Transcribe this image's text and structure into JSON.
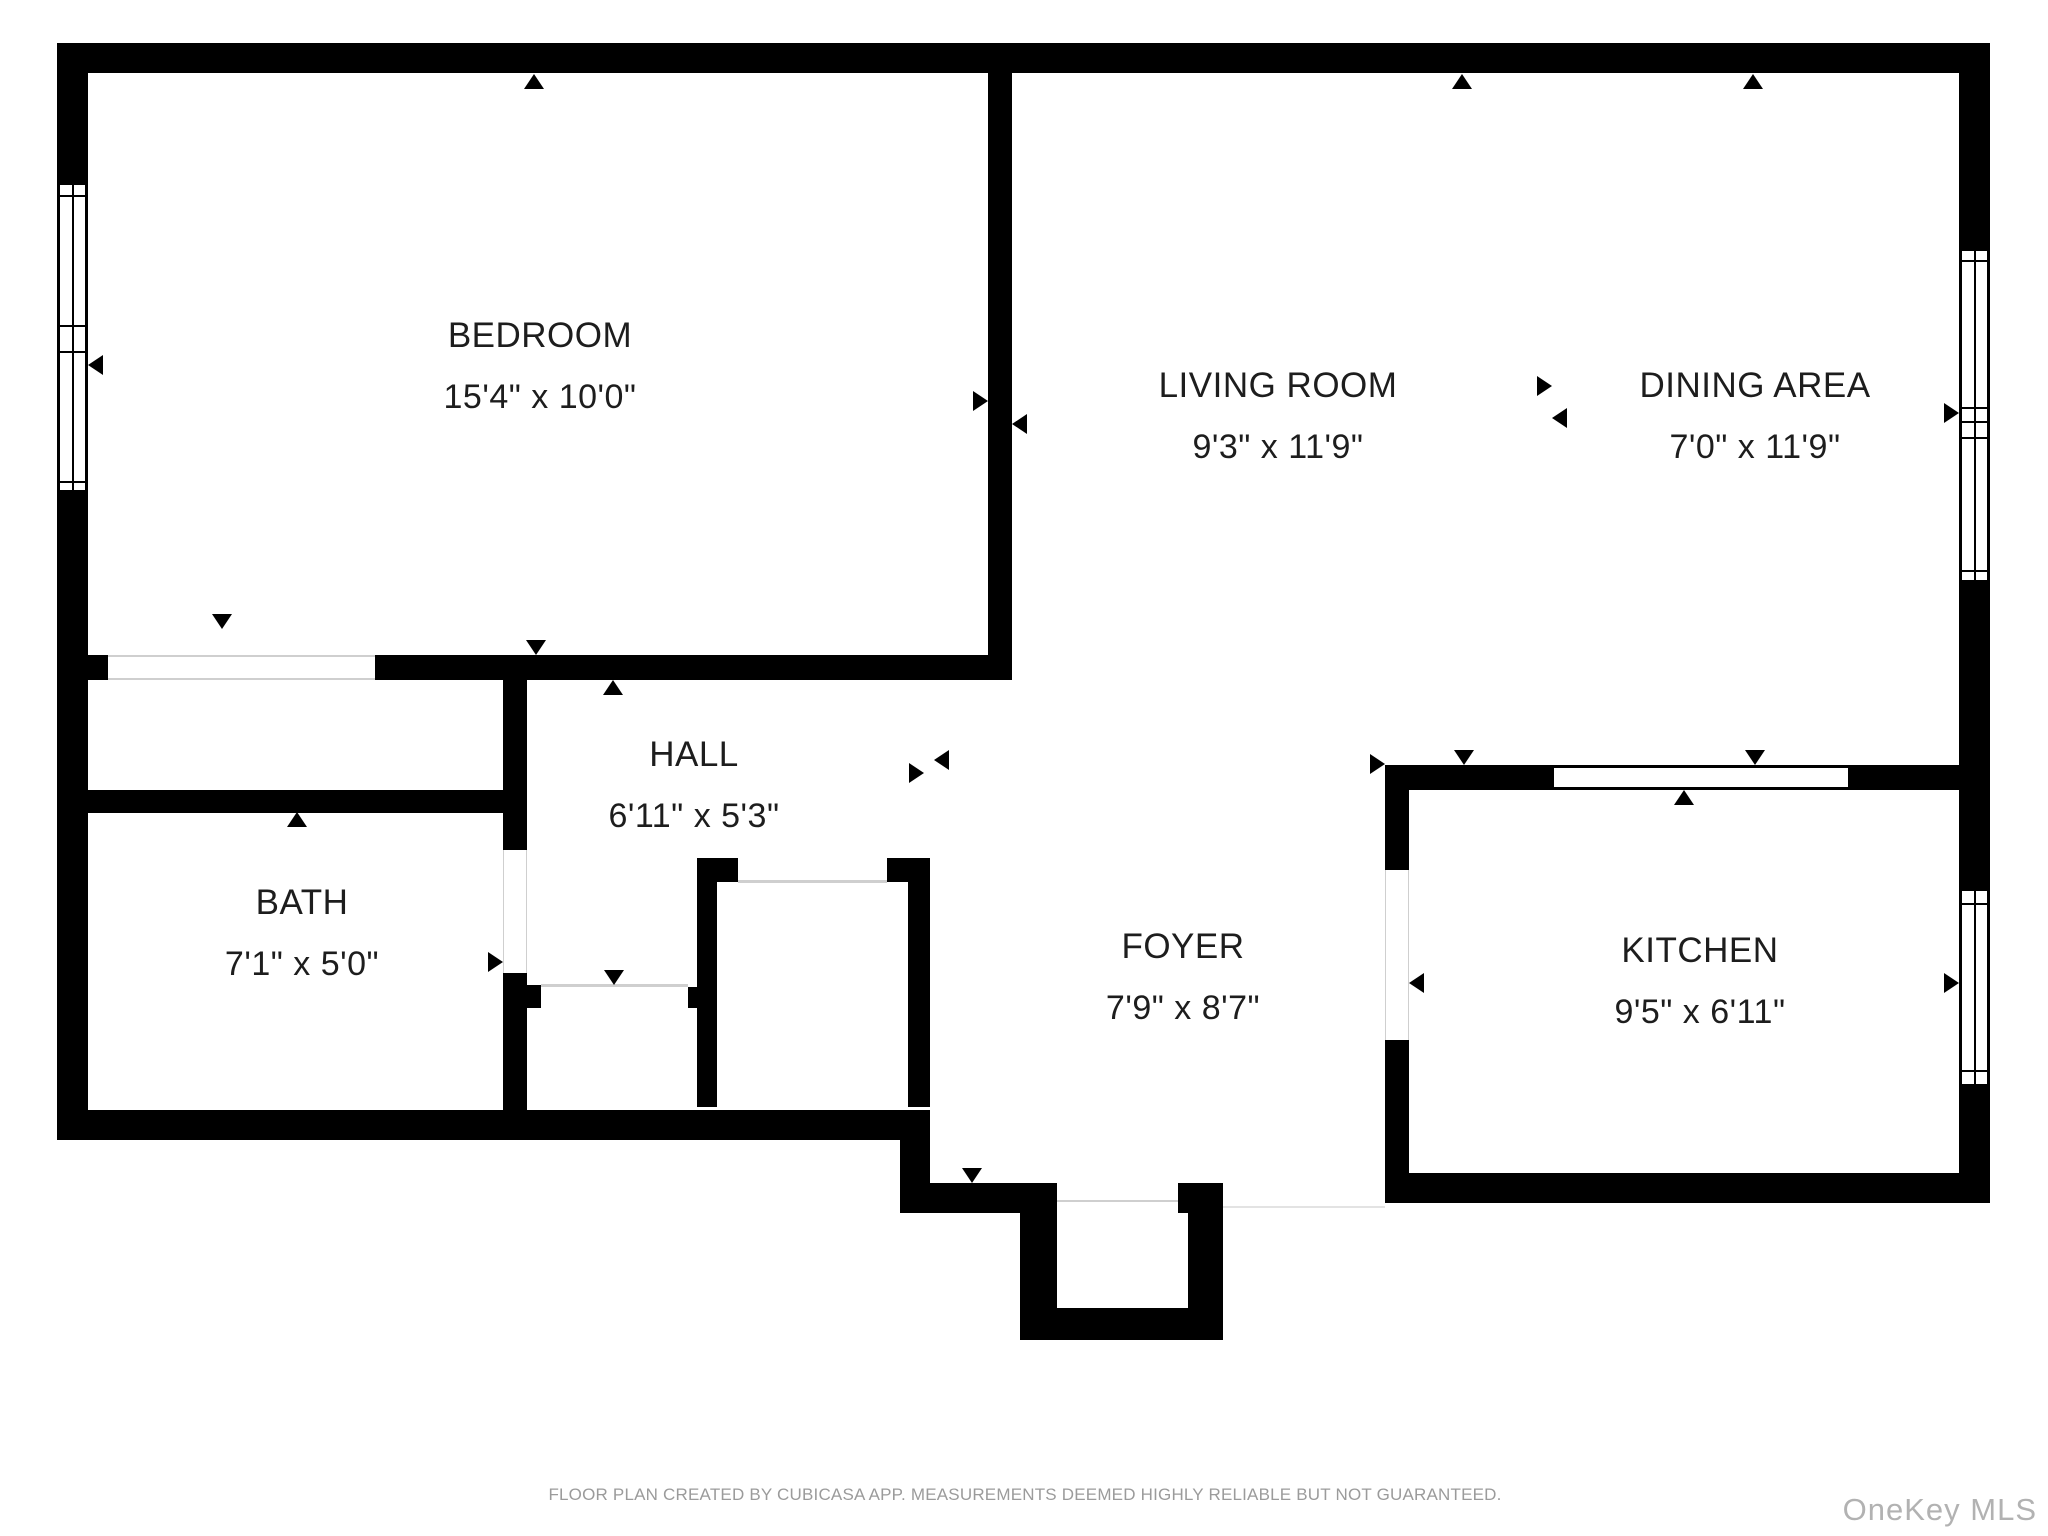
{
  "floor_plan": {
    "rooms": [
      {
        "id": "bedroom",
        "name": "BEDROOM",
        "dimensions": "15'4\" x 10'0\""
      },
      {
        "id": "living-room",
        "name": "LIVING ROOM",
        "dimensions": "9'3\" x 11'9\""
      },
      {
        "id": "dining-area",
        "name": "DINING AREA",
        "dimensions": "7'0\" x 11'9\""
      },
      {
        "id": "hall",
        "name": "HALL",
        "dimensions": "6'11\" x 5'3\""
      },
      {
        "id": "bath",
        "name": "BATH",
        "dimensions": "7'1\" x 5'0\""
      },
      {
        "id": "foyer",
        "name": "FOYER",
        "dimensions": "7'9\" x 8'7\""
      },
      {
        "id": "kitchen",
        "name": "KITCHEN",
        "dimensions": "9'5\" x 6'11\""
      }
    ],
    "footer_note": "FLOOR PLAN CREATED BY CUBICASA APP. MEASUREMENTS DEEMED HIGHLY RELIABLE BUT NOT GUARANTEED.",
    "watermark": "OneKey MLS",
    "colors": {
      "wall": "#000000",
      "background": "#ffffff",
      "label_text": "#1d1d1d",
      "footer_text": "#9b9b9b",
      "watermark_text": "#b2b2b2",
      "opening_line": "#cfcfcf"
    },
    "icons": {
      "wall_marker": "small black triangle pointing at wall"
    }
  }
}
